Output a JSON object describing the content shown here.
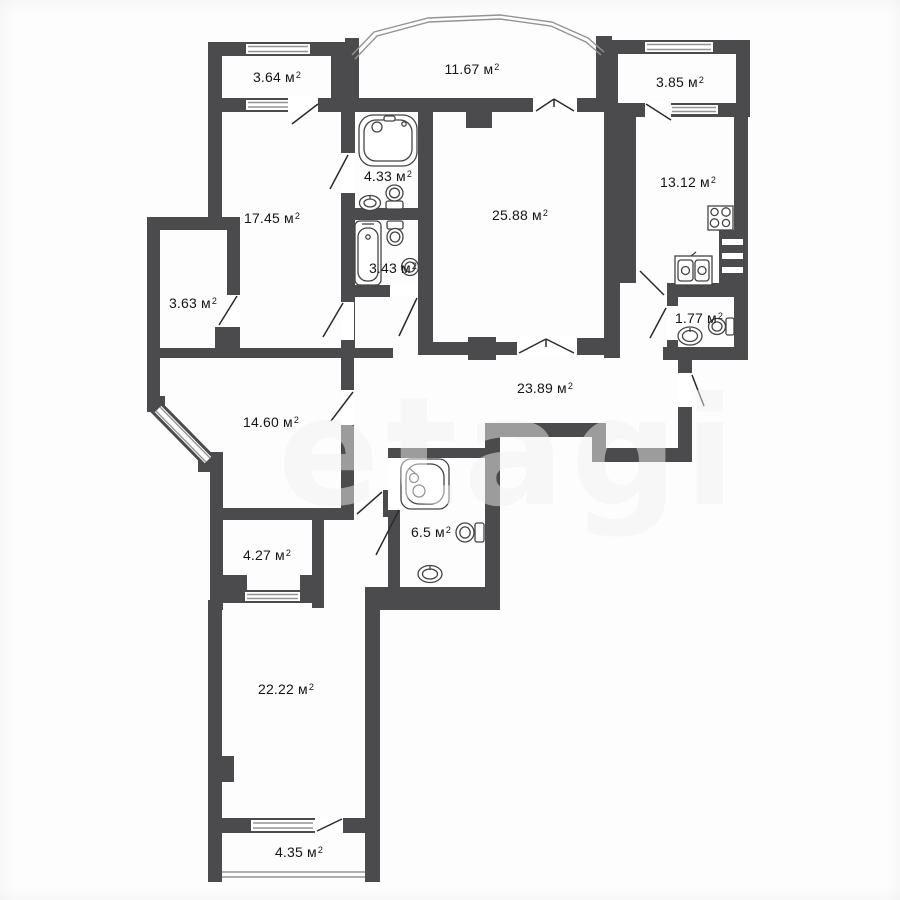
{
  "document": {
    "type": "apartment-floor-plan",
    "watermark": {
      "text": "etagi"
    }
  },
  "palette": {
    "wall": "#4b4b4e",
    "background": "#fdfdfd",
    "label_text": "#151515",
    "glazing_line": "#949494",
    "door_line": "#2b2b2b",
    "fixture_line": "#444444"
  },
  "rooms": [
    {
      "id": "balcony-top-left",
      "area": "3.64",
      "unit": "м",
      "sup": "2"
    },
    {
      "id": "balcony-top-center",
      "area": "11.67",
      "unit": "м",
      "sup": "2"
    },
    {
      "id": "balcony-top-right",
      "area": "3.85",
      "unit": "м",
      "sup": "2"
    },
    {
      "id": "room-upper-left",
      "area": "17.45",
      "unit": "м",
      "sup": "2"
    },
    {
      "id": "bathroom-upper",
      "area": "4.33",
      "unit": "м",
      "sup": "2"
    },
    {
      "id": "living-room",
      "area": "25.88",
      "unit": "м",
      "sup": "2"
    },
    {
      "id": "kitchen",
      "area": "13.12",
      "unit": "м",
      "sup": "2"
    },
    {
      "id": "storage-left",
      "area": "3.63",
      "unit": "м",
      "sup": "2"
    },
    {
      "id": "bathroom-middle",
      "area": "3.43",
      "unit": "м",
      "sup": "2"
    },
    {
      "id": "wc",
      "area": "1.77",
      "unit": "м",
      "sup": "2"
    },
    {
      "id": "hallway",
      "area": "23.89",
      "unit": "м",
      "sup": "2"
    },
    {
      "id": "room-middle-left",
      "area": "14.60",
      "unit": "м",
      "sup": "2"
    },
    {
      "id": "closet",
      "area": "4.27",
      "unit": "м",
      "sup": "2"
    },
    {
      "id": "bathroom-lower",
      "area": "6.5",
      "unit": "м",
      "sup": "2"
    },
    {
      "id": "bedroom-lower",
      "area": "22.22",
      "unit": "м",
      "sup": "2"
    },
    {
      "id": "balcony-bottom",
      "area": "4.35",
      "unit": "м",
      "sup": "2"
    }
  ],
  "fixtures": [
    {
      "icon": "corner-washbasin-icon",
      "room": "bathroom-upper"
    },
    {
      "icon": "washbasin-icon",
      "room": "bathroom-upper"
    },
    {
      "icon": "toilet-icon",
      "room": "bathroom-upper"
    },
    {
      "icon": "bathtub-icon",
      "room": "bathroom-middle"
    },
    {
      "icon": "toilet-icon",
      "room": "bathroom-middle"
    },
    {
      "icon": "washbasin-icon",
      "room": "bathroom-middle"
    },
    {
      "icon": "stove-icon",
      "room": "kitchen"
    },
    {
      "icon": "double-sink-icon",
      "room": "kitchen"
    },
    {
      "icon": "toilet-icon",
      "room": "wc"
    },
    {
      "icon": "washbasin-icon",
      "room": "wc"
    },
    {
      "icon": "shower-icon",
      "room": "bathroom-lower"
    },
    {
      "icon": "toilet-icon",
      "room": "bathroom-lower"
    },
    {
      "icon": "washbasin-icon",
      "room": "bathroom-lower"
    }
  ]
}
